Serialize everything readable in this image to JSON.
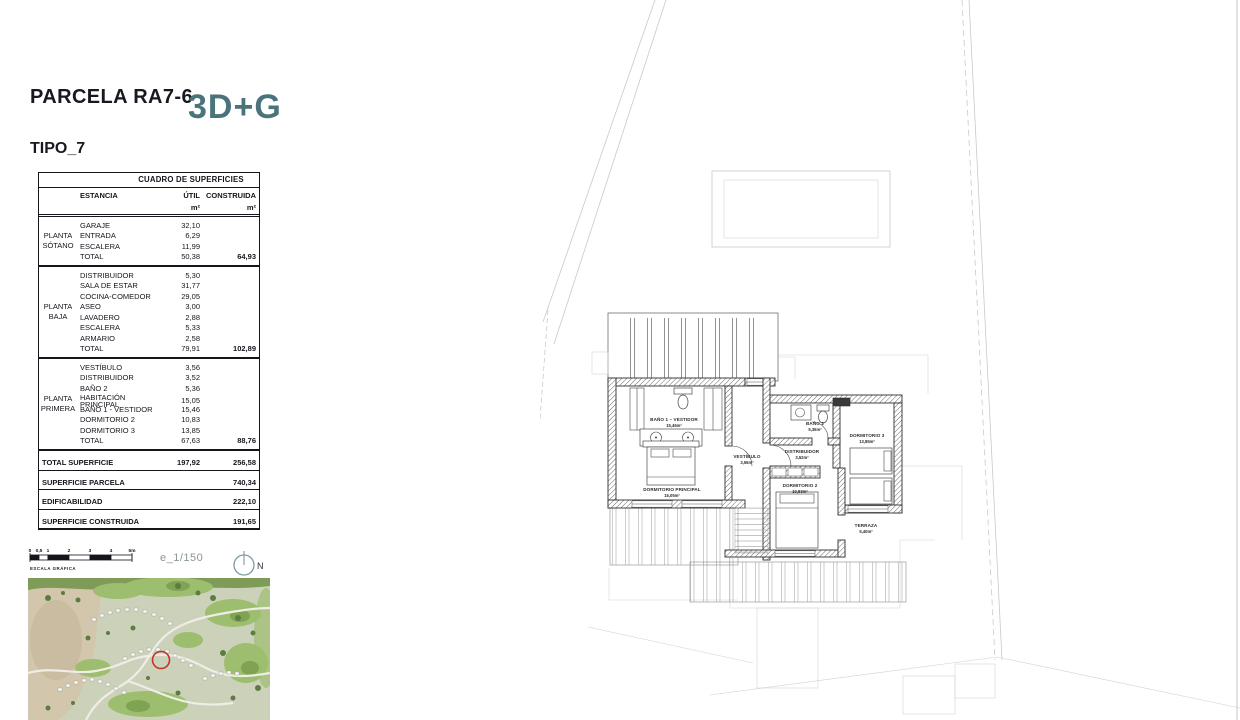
{
  "header": {
    "parcel_title": "PARCELA RA7-6",
    "logo": "3D+G",
    "tipo": "TIPO_7"
  },
  "table": {
    "title": "CUADRO DE SUPERFICIES",
    "col_estancia": "ESTANCIA",
    "col_util": "ÚTIL",
    "col_construida": "CONSTRUIDA",
    "unit": "m²",
    "sections": [
      {
        "floor": "PLANTA SÓTANO",
        "rows": [
          [
            "GARAJE",
            "32,10"
          ],
          [
            "ENTRADA",
            "6,29"
          ],
          [
            "ESCALERA",
            "11,99"
          ]
        ],
        "total_label": "TOTAL",
        "total_util": "50,38",
        "total_construida": "64,93"
      },
      {
        "floor": "PLANTA BAJA",
        "rows": [
          [
            "DISTRIBUIDOR",
            "5,30"
          ],
          [
            "SALA DE ESTAR",
            "31,77"
          ],
          [
            "COCINA-COMEDOR",
            "29,05"
          ],
          [
            "ASEO",
            "3,00"
          ],
          [
            "LAVADERO",
            "2,88"
          ],
          [
            "ESCALERA",
            "5,33"
          ],
          [
            "ARMARIO",
            "2,58"
          ]
        ],
        "total_label": "TOTAL",
        "total_util": "79,91",
        "total_construida": "102,89"
      },
      {
        "floor": "PLANTA PRIMERA",
        "rows": [
          [
            "VESTÍBULO",
            "3,56"
          ],
          [
            "DISTRIBUIDOR",
            "3,52"
          ],
          [
            "BAÑO 2",
            "5,36"
          ],
          [
            "HABITACIÓN PRINCIPAL",
            "15,05"
          ],
          [
            "BAÑO 1 - VESTIDOR",
            "15,46"
          ],
          [
            "DORMITORIO 2",
            "10,83"
          ],
          [
            "DORMITORIO 3",
            "13,85"
          ]
        ],
        "total_label": "TOTAL",
        "total_util": "67,63",
        "total_construida": "88,76"
      }
    ],
    "summary": [
      {
        "label": "TOTAL SUPERFICIE",
        "util": "197,92",
        "construida": "256,58"
      },
      {
        "label": "SUPERFICIE PARCELA",
        "util": "",
        "construida": "740,34"
      },
      {
        "label": "EDIFICABILIDAD",
        "util": "",
        "construida": "222,10"
      },
      {
        "label": "SUPERFICIE CONSTRUIDA",
        "util": "",
        "construida": "191,65"
      }
    ]
  },
  "scale": {
    "ticks": [
      "0",
      "0,5",
      "1",
      "2",
      "3",
      "4",
      "5m"
    ],
    "caption": "ESCALA GRÁFICA",
    "ratio": "e_1/150",
    "north": "N"
  },
  "plan": {
    "rooms": [
      {
        "name": "BAÑO 1 – VESTIDOR",
        "area": "15,46m²"
      },
      {
        "name": "DORMITORIO PRINCIPAL",
        "area": "15,05m²"
      },
      {
        "name": "VESTÍBULO",
        "area": "3,56m²"
      },
      {
        "name": "DISTRIBUIDOR",
        "area": "3,52m²"
      },
      {
        "name": "BAÑO 2",
        "area": "5,36m²"
      },
      {
        "name": "DORMITORIO 3",
        "area": "13,85m²"
      },
      {
        "name": "DORMITORIO 2",
        "area": "10,83m²"
      },
      {
        "name": "TERRAZA",
        "area": "5,40m²"
      }
    ]
  },
  "colors": {
    "logo_teal": "#4a737b",
    "marker_red": "#c2332b",
    "wall_dark": "#2f2f2f",
    "site_light": "#c9c9c9"
  }
}
